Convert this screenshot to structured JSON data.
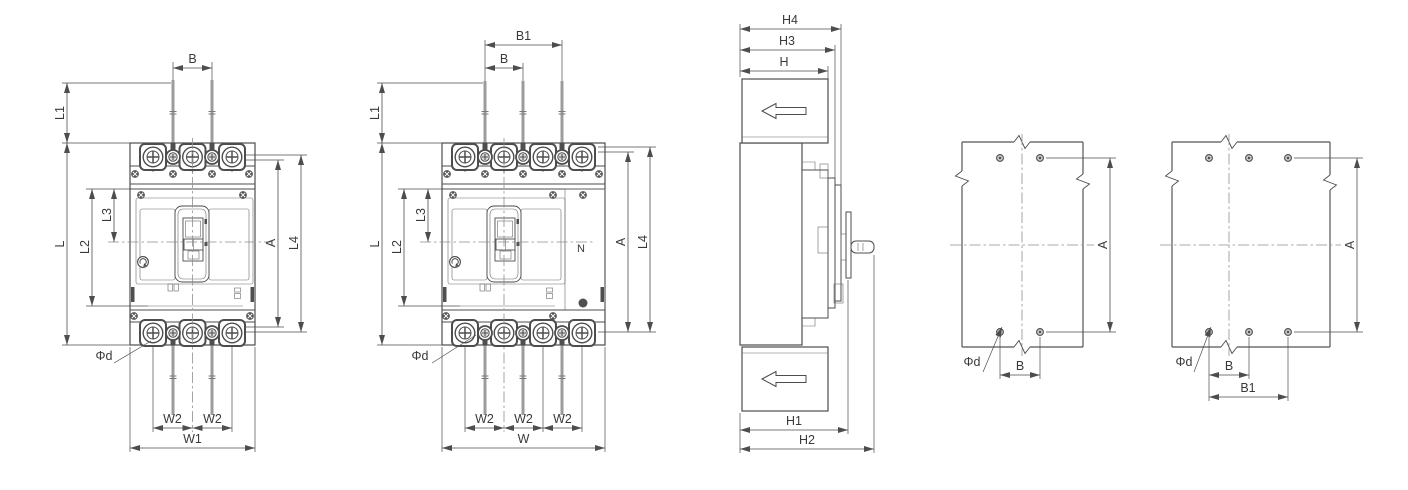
{
  "figure": {
    "description": "Outline and installation dimension drawing, molded case circuit breaker, 3-pole and 4-pole",
    "background_color": "#ffffff",
    "line_color": "#4d4d4d",
    "conductor_color": "#9c9c9c",
    "views": [
      {
        "id": "front-view-3-pole",
        "dimension_labels": [
          "B",
          "L1",
          "L",
          "L3",
          "L2",
          "A",
          "L4",
          "Φd",
          "W2",
          "W2",
          "W1"
        ]
      },
      {
        "id": "front-view-4-pole",
        "dimension_labels": [
          "B1",
          "B",
          "L1",
          "L",
          "L3",
          "L2",
          "N",
          "A",
          "L4",
          "Φd",
          "W2",
          "W2",
          "W2",
          "W"
        ]
      },
      {
        "id": "side-view",
        "dimension_labels": [
          "H4",
          "H3",
          "H",
          "H1",
          "H2"
        ]
      },
      {
        "id": "mounting-drilling-plan-3-pole",
        "dimension_labels": [
          "A",
          "Φd",
          "B"
        ]
      },
      {
        "id": "mounting-drilling-plan-4-pole",
        "dimension_labels": [
          "A",
          "Φd",
          "B",
          "B1"
        ]
      }
    ]
  },
  "dims": {
    "B": "B",
    "B1": "B1",
    "L": "L",
    "L1": "L1",
    "L2": "L2",
    "L3": "L3",
    "L4": "L4",
    "A": "A",
    "N": "N",
    "phi_d": "Φd",
    "W": "W",
    "W1": "W1",
    "W2": "W2",
    "H": "H",
    "H1": "H1",
    "H2": "H2",
    "H3": "H3",
    "H4": "H4"
  }
}
